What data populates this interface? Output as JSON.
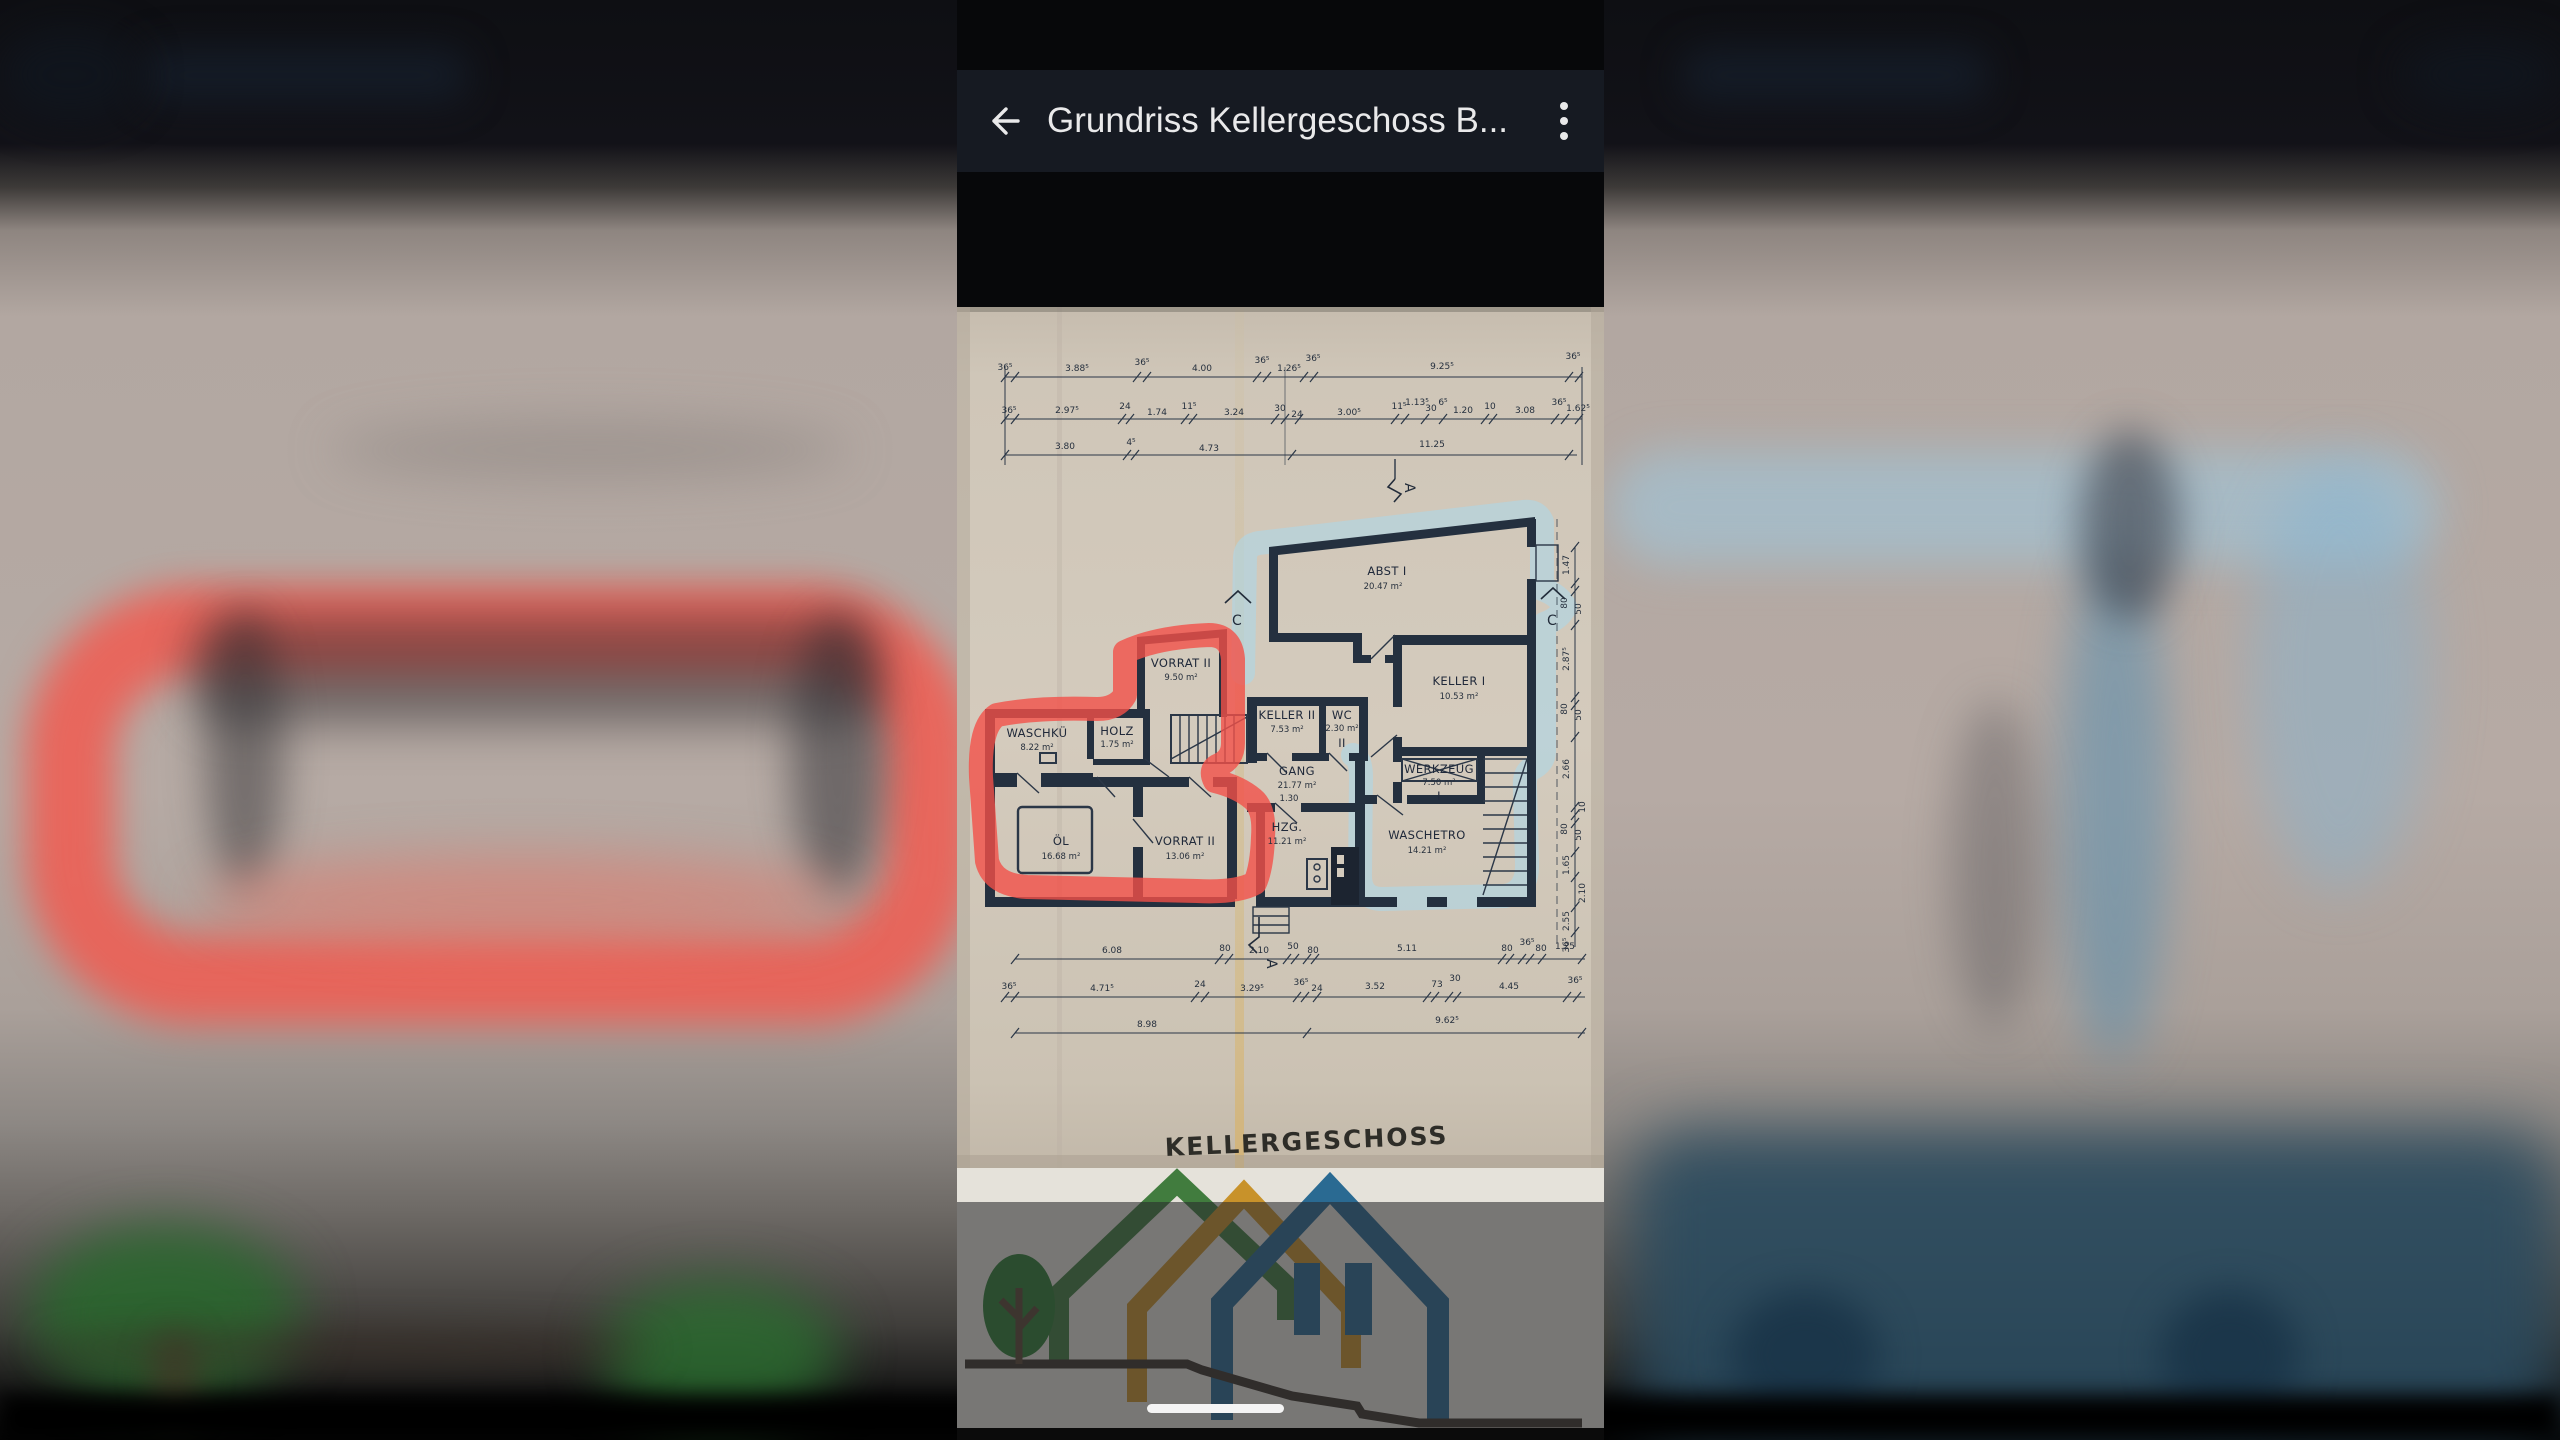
{
  "app_bar": {
    "title": "Grundriss Kellergeschoss B...",
    "back_icon": "arrow-left-icon",
    "menu_icon": "kebab-menu-icon"
  },
  "plan": {
    "caption": "KELLERGESCHOSS",
    "rooms": {
      "abst": {
        "name": "ABST I",
        "area": "20.47 m²"
      },
      "keller1": {
        "name": "KELLER I",
        "area": "10.53 m²"
      },
      "vorrat_top": {
        "name": "VORRAT II",
        "area": "9.50 m²"
      },
      "keller2": {
        "name": "KELLER II",
        "area": "7.53 m²"
      },
      "wc": {
        "name": "WC",
        "area": "2.30 m²",
        "suffix": "II"
      },
      "waschku": {
        "name": "WASCHKÜ",
        "area": "8.22 m²"
      },
      "holz": {
        "name": "HOLZ",
        "area": "1.75 m²"
      },
      "gang": {
        "name": "GANG",
        "area": "21.77 m²"
      },
      "werkzeug": {
        "name": "WERKZEUG",
        "area": "7.50 m²",
        "suffix": "I"
      },
      "oel": {
        "name": "ÖL",
        "area": "16.68 m²"
      },
      "vorrat_bottom": {
        "name": "VORRAT II",
        "area": "13.06 m²"
      },
      "hzg": {
        "name": "HZG.",
        "area": "11.21 m²"
      },
      "waeschetro": {
        "name": "WASCHETRO",
        "area": "14.21 m²"
      }
    },
    "dims_top_row1": [
      "36⁵",
      "3.88⁵",
      "36⁵",
      "4.00",
      "36⁵",
      "1.26⁵",
      "36⁵",
      "9.25⁵",
      "36⁵"
    ],
    "dims_top_row2": [
      "36⁵",
      "2.97⁵",
      "24",
      "1.74",
      "11⁵",
      "3.24",
      "30",
      "24",
      "3.00⁵",
      "11⁵",
      "1.13⁵",
      "30",
      "6⁵",
      "1.20",
      "10",
      "3.08",
      "36⁵",
      "1.62⁵"
    ],
    "dims_top_row3": [
      "3.80",
      "4⁵",
      "4.73",
      "11.25"
    ],
    "dims_bottom_row1": [
      "6.08",
      "80",
      "2.10",
      "50",
      "80",
      "5.11",
      "80",
      "36⁵",
      "80",
      "1.25"
    ],
    "dims_bottom_row2": [
      "36⁵",
      "4.71⁵",
      "24",
      "3.29⁵",
      "36⁵",
      "24",
      "3.52",
      "73",
      "30",
      "4.45",
      "36⁵"
    ],
    "dims_bottom_row3": [
      "8.98",
      "9.62⁵"
    ],
    "dims_right": [
      "1.47",
      "80",
      "50",
      "2.87⁵",
      "80",
      "50",
      "2.66",
      "10",
      "80",
      "50",
      "1.65",
      "2.10",
      "2.55",
      "36⁵"
    ],
    "extra_labels": {
      "gang_door_width": "1.30"
    },
    "markers": {
      "a_top": "A",
      "c_left": "C",
      "c_right": "C",
      "a_bottom": "A"
    },
    "annotation_colors": {
      "red_marker": "#f25049",
      "blue_marker": "#aed7e8"
    }
  }
}
